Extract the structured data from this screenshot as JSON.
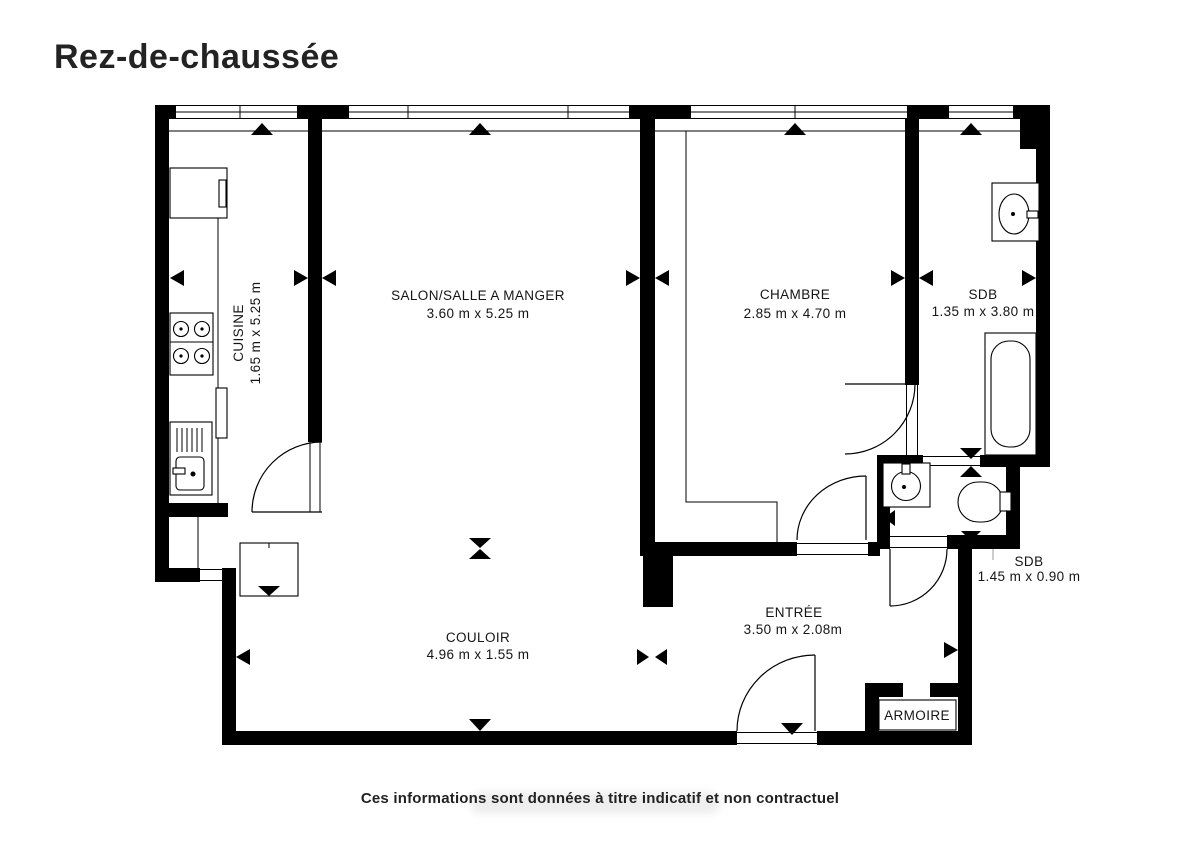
{
  "title": "Rez-de-chaussée",
  "footer": "Ces informations sont données à titre indicatif et non contractuel",
  "colors": {
    "wall": "#000000",
    "text": "#151515"
  },
  "rooms": {
    "cuisine": {
      "name": "CUISINE",
      "dims": "1.65 m x 5.25 m"
    },
    "salon": {
      "name": "SALON/SALLE A MANGER",
      "dims": "3.60 m x 5.25 m"
    },
    "chambre": {
      "name": "CHAMBRE",
      "dims": "2.85 m x 4.70 m"
    },
    "sdb_haut": {
      "name": "SDB",
      "dims": "1.35 m x 3.80 m"
    },
    "sdb_bas": {
      "name": "SDB",
      "dims": "1.45 m x 0.90 m"
    },
    "entree": {
      "name": "ENTRÉE",
      "dims": "3.50 m x 2.08m"
    },
    "couloir": {
      "name": "COULOIR",
      "dims": "4.96 m x 1.55 m"
    },
    "armoire": {
      "name": "ARMOIRE"
    }
  }
}
